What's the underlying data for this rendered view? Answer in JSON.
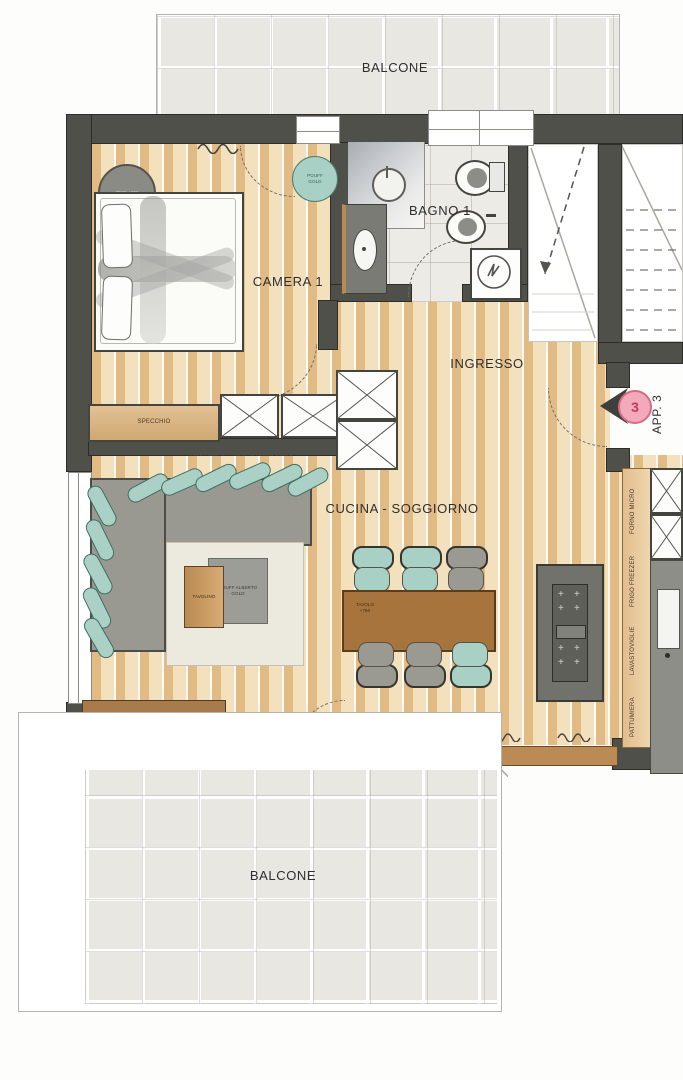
{
  "rooms": {
    "balcone_top": "BALCONE",
    "camera1": "CAMERA 1",
    "bagno1": "BAGNO 1",
    "ingresso": "INGRESSO",
    "cucina_soggiorno": "CUCINA - SOGGIORNO",
    "balcone_bottom": "BALCONE"
  },
  "entrance": {
    "apartment_label": "APP. 3",
    "door_number": "3"
  },
  "notes": {
    "wall_finish": "RIVESTIMENTO PARETE IN LEGNO LISCIO"
  },
  "furniture": {
    "mirror_cabinet": "SPECCHIO",
    "coffee_table": "TAVOLINO",
    "square_pouf": "POUFF ALBERTO GOLD",
    "round_pouf_teal": "POUFF GOLD",
    "round_pouf_gray": "Ø500 +500",
    "dining_table_note": "TAVOLO +750"
  },
  "kitchen": {
    "appliances": [
      "FORNO MICRO",
      "FRIGO FREEZER",
      "LAVASTOVIGLIE",
      "PATTUMIERA"
    ]
  },
  "colors": {
    "wall": "#50504b",
    "wood": "#e8c795",
    "tile": "#e8e7e2",
    "teal": "#abd1c6",
    "accent_pink": "#f2a9ba"
  }
}
